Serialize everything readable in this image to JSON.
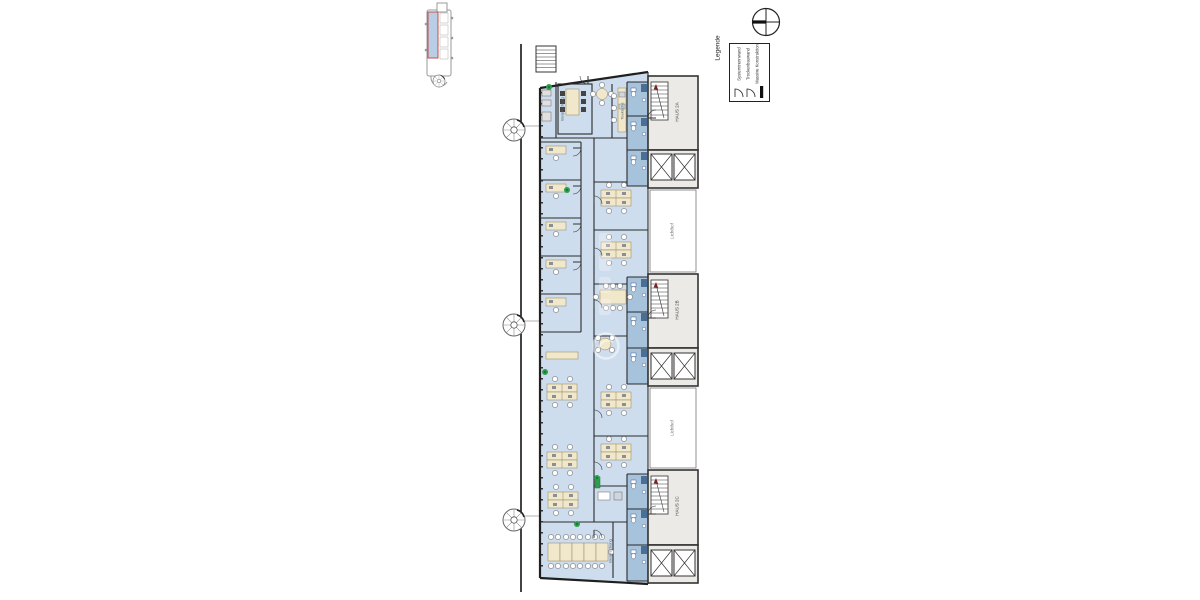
{
  "legend": {
    "title": "Legende",
    "items": [
      {
        "icon": "door-swing-icon",
        "label": "Systemtrennwand"
      },
      {
        "icon": "door-swing-icon",
        "label": "Trockenbauwand"
      },
      {
        "icon": "solid-wall-icon",
        "label": "Massive Konstruktion"
      }
    ]
  },
  "compass": {
    "icon": "north-compass-icon"
  },
  "keyplan": {
    "icon": "key-plan-thumbnail",
    "highlight_color": "#b9cde5",
    "outline_color": "#c0504d"
  },
  "plan": {
    "cores": [
      {
        "label": "HAUS 2A"
      },
      {
        "label": "HAUS 2B"
      },
      {
        "label": "HAUS 2C"
      }
    ],
    "lightwells": [
      {
        "label": "Lichthof"
      },
      {
        "label": "Lichthof"
      }
    ],
    "rooms": [
      {
        "label": "Besprechung"
      },
      {
        "label": "Teeküche"
      },
      {
        "label": "Besprechung"
      }
    ],
    "colors": {
      "office_fill": "#cedded",
      "wc_fill": "#a7c3dc",
      "core_fill": "#eceae6",
      "wall": "#222222",
      "desk": "#f1e7cb",
      "plant": "#2e9e4f"
    }
  }
}
